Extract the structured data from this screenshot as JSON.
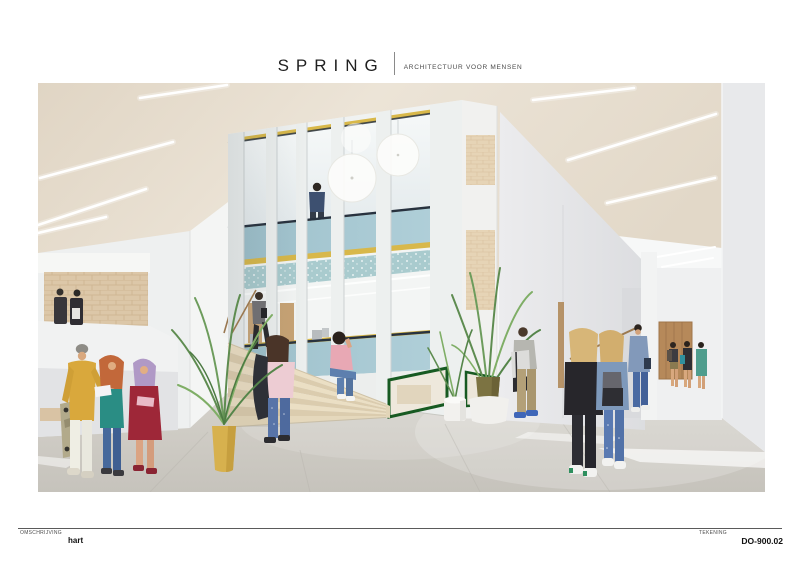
{
  "header": {
    "brand": "SPRING",
    "tagline": "ARCHITECTUUR VOOR MENSEN"
  },
  "footer": {
    "description_label": "OMSCHRIJVING",
    "description_value": "hart",
    "drawing_label": "TEKENING",
    "drawing_number": "DO-900.02"
  },
  "scene": {
    "type": "architectural interior rendering",
    "subject": "School hall ('hart') with a central two-storey glazed volume, grand stair, corridor with wooden door and students",
    "palette": {
      "ceiling_beige": "#e8dfd1",
      "wall_white": "#eff0f0",
      "glass_panel_blue": "#a7c9d3",
      "frame_yellow": "#d8b84a",
      "frame_navy": "#28323f",
      "frame_green": "#175a22",
      "floor_grey": "#cecbc4",
      "stair_cream": "#e9dfc5",
      "door_wood": "#b6895a",
      "brick_beige": "#dcc7a8",
      "plant_green": "#5e8c50",
      "pot_gold": "#d7b14e"
    }
  }
}
